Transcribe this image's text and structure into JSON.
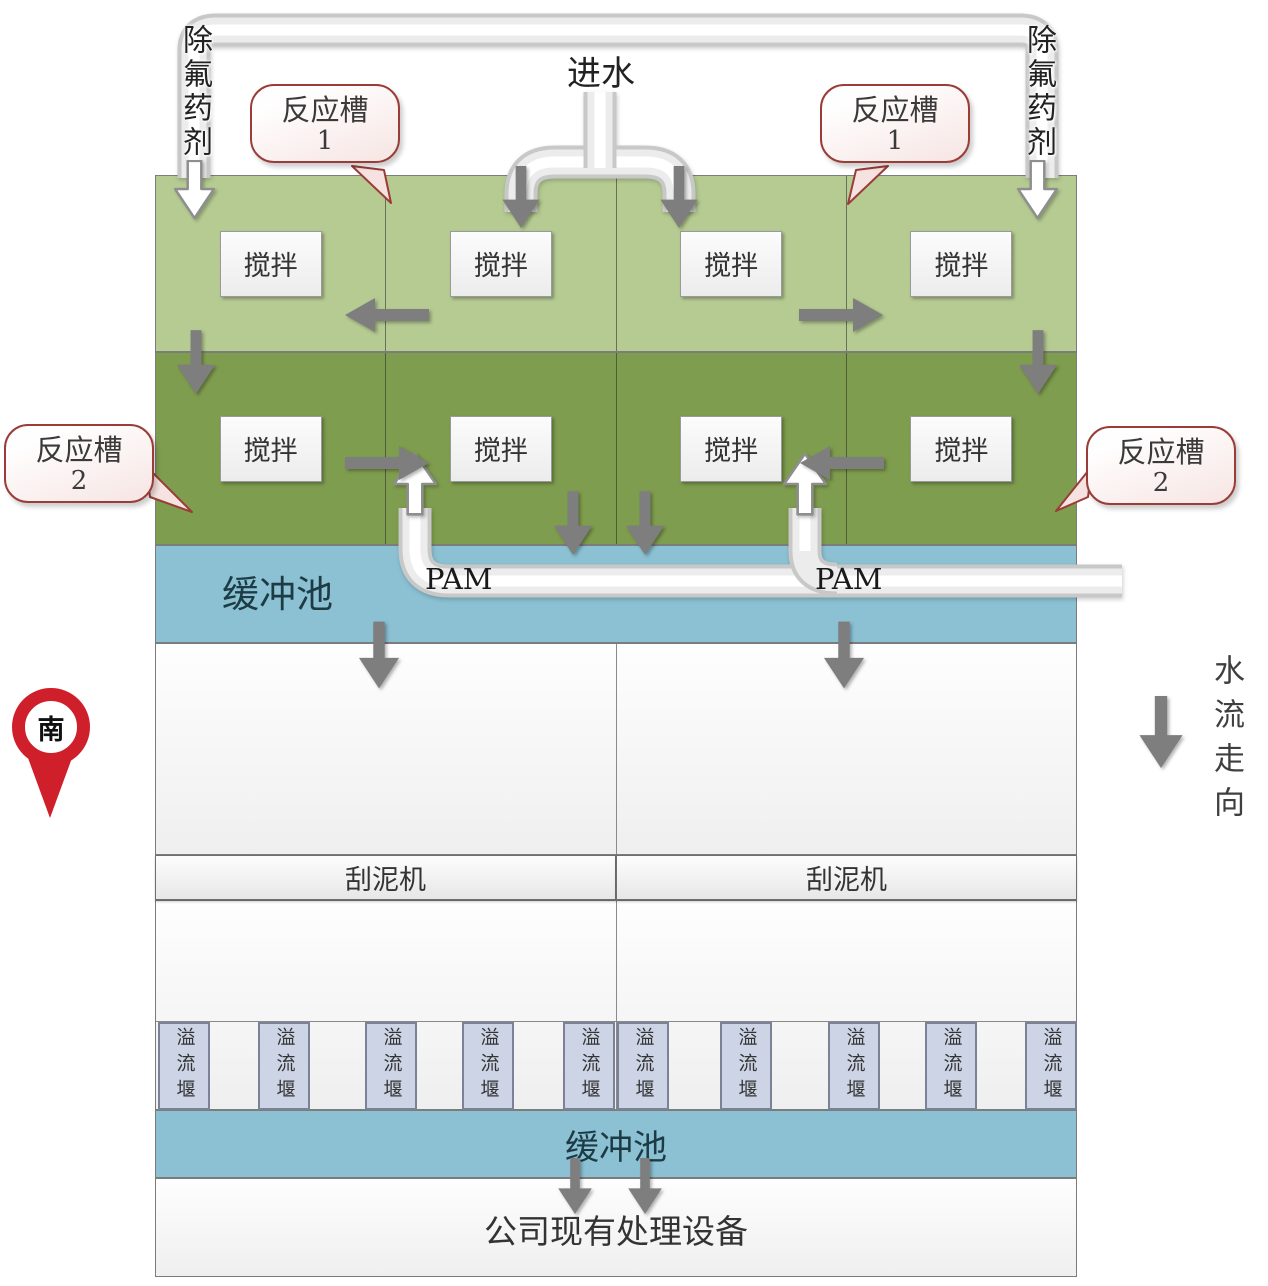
{
  "labels": {
    "inlet": "进水",
    "defluoridation_left": "除氟药剂",
    "defluoridation_right": "除氟药剂",
    "south": "南",
    "flow_direction": "水流走向",
    "existing_equipment": "公司现有处理设备"
  },
  "callouts": [
    {
      "title": "反应槽",
      "num": "1"
    },
    {
      "title": "反应槽",
      "num": "1"
    },
    {
      "title": "反应槽",
      "num": "2"
    },
    {
      "title": "反应槽",
      "num": "2"
    }
  ],
  "stir_cells": [
    "搅拌",
    "搅拌",
    "搅拌",
    "搅拌",
    "搅拌",
    "搅拌",
    "搅拌",
    "搅拌"
  ],
  "pam": [
    "PAM",
    "PAM"
  ],
  "buffer_pools": [
    "缓冲池",
    "缓冲池"
  ],
  "scrapers": [
    "刮泥机",
    "刮泥机"
  ],
  "weirs": [
    "溢流堰",
    "溢流堰",
    "溢流堰",
    "溢流堰",
    "溢流堰",
    "溢流堰",
    "溢流堰",
    "溢流堰",
    "溢流堰",
    "溢流堰"
  ],
  "icons": {
    "south_pin": "map-pin-icon",
    "flow_arrow": "down-arrow-icon",
    "dosing_arrow": "hollow-down-arrow-icon",
    "pam_arrow": "hollow-up-arrow-icon"
  },
  "colors": {
    "tank_row1_green": "#b5cb92",
    "tank_row2_green": "#7f9d4e",
    "buffer_blue": "#8bc1d3",
    "weir_fill": "#ccd4e6",
    "callout_border": "#9a3c38",
    "pin_red": "#cf1f2a",
    "arrow_gray": "#7e7e7e",
    "pipe_white": "#f2f2f2"
  }
}
